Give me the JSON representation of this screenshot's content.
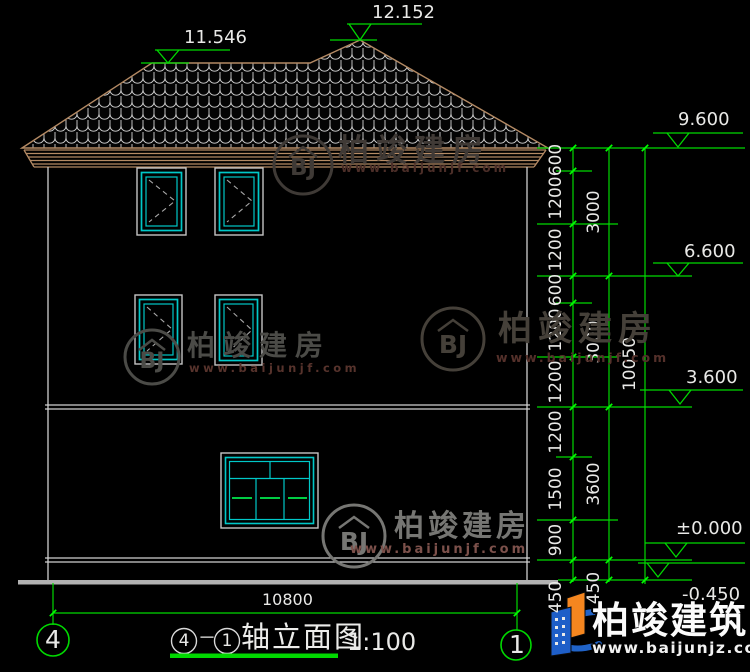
{
  "levels": {
    "roof_break": "11.546",
    "roof_peak": "12.152",
    "eave": "9.600",
    "floor3": "6.600",
    "floor2": "3.600",
    "ground": "±0.000",
    "site": "-0.450"
  },
  "dims": {
    "inner": [
      "600",
      "1200",
      "1200",
      "600",
      "1200",
      "1200",
      "1200",
      "1500",
      "900",
      "450"
    ],
    "middle": [
      "3000",
      "3000",
      "3600",
      "450"
    ],
    "total": "10050",
    "width": "10800"
  },
  "axes": {
    "left": "4",
    "right": "1"
  },
  "title": {
    "start": "4",
    "dash": "－",
    "end": "1",
    "name": "轴立面图",
    "scale": "1:100"
  },
  "watermark": {
    "initials": "BJ",
    "brand": "柏竣建房",
    "site": "www.baijunjf.com"
  },
  "footer": {
    "brand": "柏竣建筑",
    "site": "www.baijunjz.com"
  },
  "colors": {
    "dimension_green": "#00d900",
    "window_cyan": "#00c8c8",
    "roof_tan": "#b48a64"
  }
}
